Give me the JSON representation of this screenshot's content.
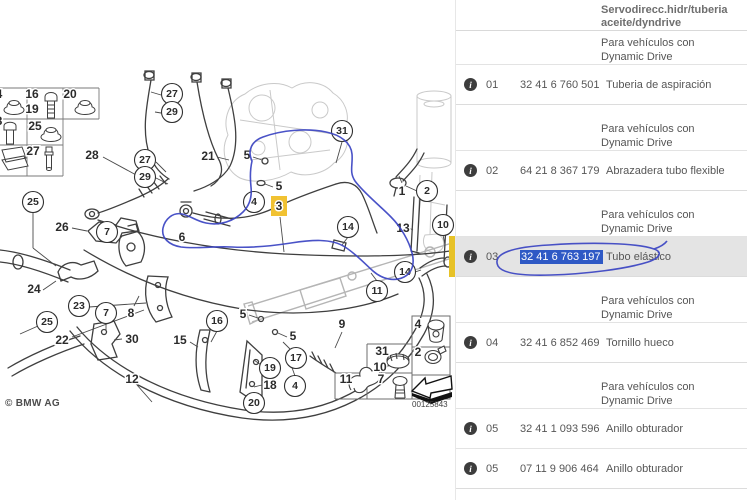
{
  "diagram": {
    "copyright": "© BMW AG",
    "drawing_number": "00125843",
    "highlight_color": "#f1c232",
    "ink_color": "#3a43c2",
    "callouts": [
      {
        "t": "27",
        "x": 172,
        "y": 94,
        "c": 1
      },
      {
        "t": "29",
        "x": 172,
        "y": 112,
        "c": 1
      },
      {
        "t": "27",
        "x": 145,
        "y": 160,
        "c": 1
      },
      {
        "t": "29",
        "x": 145,
        "y": 177,
        "c": 1
      },
      {
        "t": "31",
        "x": 342,
        "y": 131,
        "c": 1
      },
      {
        "t": "28",
        "x": 92,
        "y": 155
      },
      {
        "t": "21",
        "x": 208,
        "y": 156
      },
      {
        "t": "5",
        "x": 247,
        "y": 155
      },
      {
        "t": "5",
        "x": 279,
        "y": 186
      },
      {
        "t": "4",
        "x": 254,
        "y": 202,
        "c": 1
      },
      {
        "t": "3",
        "x": 279,
        "y": 206,
        "hl": 1
      },
      {
        "t": "1",
        "x": 402,
        "y": 191
      },
      {
        "t": "2",
        "x": 427,
        "y": 191,
        "c": 1
      },
      {
        "t": "26",
        "x": 62,
        "y": 227
      },
      {
        "t": "7",
        "x": 107,
        "y": 232,
        "c": 1
      },
      {
        "t": "6",
        "x": 182,
        "y": 237
      },
      {
        "t": "25",
        "x": 33,
        "y": 202,
        "c": 1
      },
      {
        "t": "14",
        "x": 348,
        "y": 227,
        "c": 1
      },
      {
        "t": "13",
        "x": 403,
        "y": 228
      },
      {
        "t": "10",
        "x": 443,
        "y": 225,
        "c": 1
      },
      {
        "t": "24",
        "x": 34,
        "y": 289
      },
      {
        "t": "23",
        "x": 79,
        "y": 306,
        "c": 1
      },
      {
        "t": "25",
        "x": 47,
        "y": 322,
        "c": 1
      },
      {
        "t": "22",
        "x": 62,
        "y": 340
      },
      {
        "t": "7",
        "x": 106,
        "y": 313,
        "c": 1
      },
      {
        "t": "8",
        "x": 131,
        "y": 313
      },
      {
        "t": "30",
        "x": 132,
        "y": 339
      },
      {
        "t": "12",
        "x": 132,
        "y": 379
      },
      {
        "t": "16",
        "x": 217,
        "y": 321,
        "c": 1
      },
      {
        "t": "15",
        "x": 180,
        "y": 340
      },
      {
        "t": "14",
        "x": 405,
        "y": 272,
        "c": 1
      },
      {
        "t": "11",
        "x": 377,
        "y": 291,
        "c": 1
      },
      {
        "t": "9",
        "x": 342,
        "y": 324
      },
      {
        "t": "5",
        "x": 243,
        "y": 314
      },
      {
        "t": "5",
        "x": 293,
        "y": 336
      },
      {
        "t": "17",
        "x": 296,
        "y": 358,
        "c": 1
      },
      {
        "t": "19",
        "x": 270,
        "y": 368,
        "c": 1
      },
      {
        "t": "18",
        "x": 270,
        "y": 385
      },
      {
        "t": "4",
        "x": 295,
        "y": 386,
        "c": 1
      },
      {
        "t": "20",
        "x": 254,
        "y": 403,
        "c": 1
      },
      {
        "t": "16",
        "x": 32,
        "y": 94,
        "g": 1
      },
      {
        "t": "19",
        "x": 32,
        "y": 109,
        "g": 1
      },
      {
        "t": "20",
        "x": 70,
        "y": 94,
        "g": 1
      },
      {
        "t": "25",
        "x": 35,
        "y": 126,
        "g": 1
      },
      {
        "t": "27",
        "x": 33,
        "y": 151,
        "g": 1
      },
      {
        "t": "4",
        "x": -1,
        "y": 94,
        "g": 1
      },
      {
        "t": "8",
        "x": -1,
        "y": 121,
        "g": 1
      },
      {
        "t": "4",
        "x": 418,
        "y": 324,
        "g": 1
      },
      {
        "t": "2",
        "x": 418,
        "y": 352,
        "g": 1
      },
      {
        "t": "31",
        "x": 382,
        "y": 351,
        "g": 1
      },
      {
        "t": "10",
        "x": 380,
        "y": 367,
        "g": 1
      },
      {
        "t": "7",
        "x": 381,
        "y": 379,
        "g": 1
      },
      {
        "t": "11",
        "x": 346,
        "y": 379,
        "g": 1
      }
    ]
  },
  "table": {
    "title_lines": [
      "Servodirecc.hidr/tuberia",
      "aceite/dyndrive"
    ],
    "note_lines": [
      "Para vehículos con",
      "Dynamic Drive"
    ],
    "selection_color": "#2e59c5",
    "highlight_bar_color": "#e7c227",
    "sections": [
      {
        "rows": [
          {
            "pos": "01",
            "part": "32 41 6 760 501",
            "desc": "Tuberia de aspiración"
          }
        ]
      },
      {
        "rows": [
          {
            "pos": "02",
            "part": "64 21 8 367 179",
            "desc": "Abrazadera tubo flexible"
          }
        ]
      },
      {
        "rows": [
          {
            "pos": "03",
            "part": "32 41 6 763 197",
            "desc": "Tubo elástico",
            "selected": true
          }
        ]
      },
      {
        "rows": [
          {
            "pos": "04",
            "part": "32 41 6 852 469",
            "desc": "Tornillo hueco"
          }
        ]
      },
      {
        "rows": [
          {
            "pos": "05",
            "part": "32 41 1 093 596",
            "desc": "Anillo obturador"
          },
          {
            "pos": "05",
            "part": "07 11 9 906 464",
            "desc": "Anillo obturador"
          }
        ]
      }
    ]
  }
}
